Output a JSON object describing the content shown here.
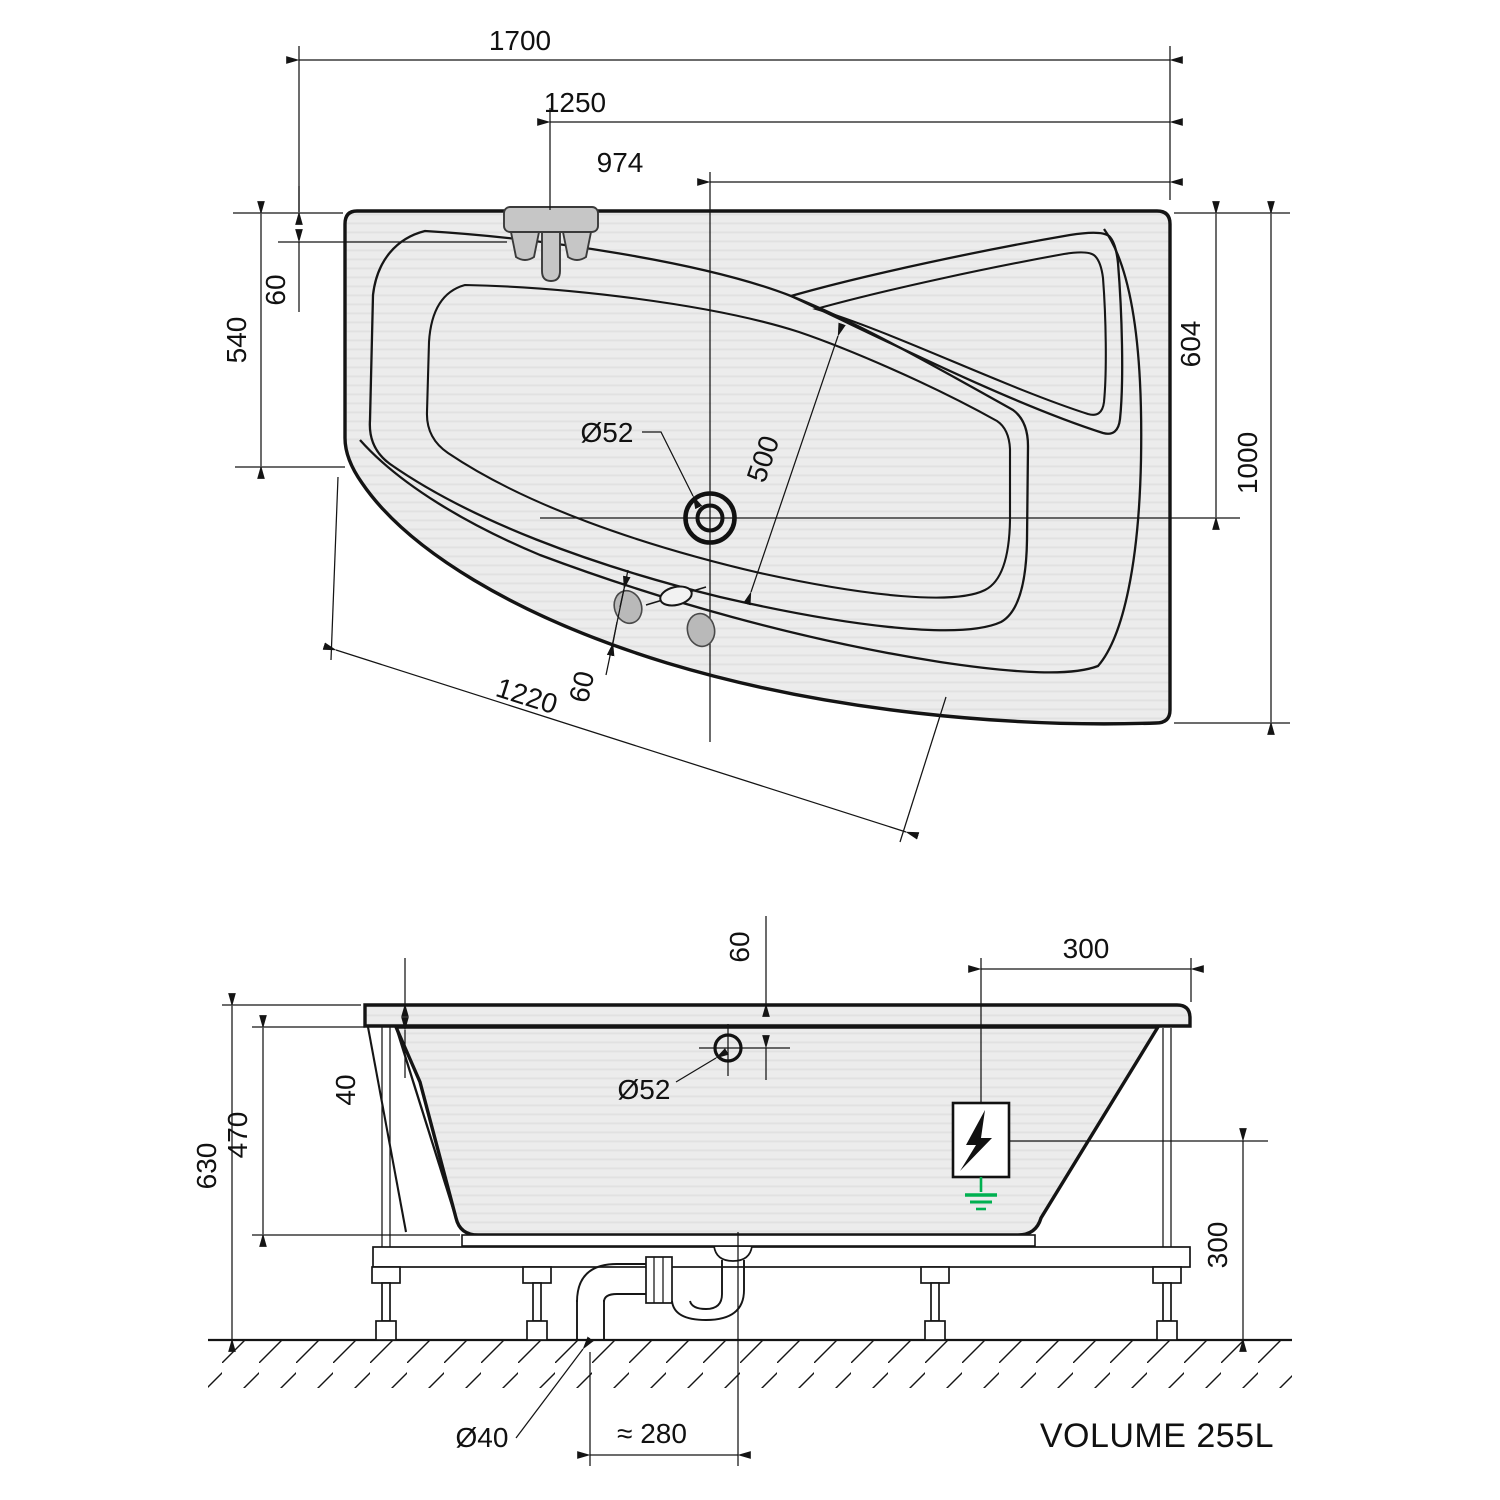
{
  "top_view": {
    "dims": {
      "overall_length": "1700",
      "tap_distance": "1250",
      "drain_offset_x": "974",
      "deck_offset": "60",
      "left_end_width": "540",
      "drain_offset_y": "604",
      "right_end_width": "1000",
      "drain_diameter": "Ø52",
      "basin_width": "500",
      "front_edge_length": "1220",
      "rim_width": "60"
    }
  },
  "side_view": {
    "dims": {
      "overflow_offset": "60",
      "electric_inset": "300",
      "overall_height": "630",
      "shell_depth": "470",
      "rim_height": "40",
      "overflow_diameter": "Ø52",
      "electric_height": "300",
      "waste_pipe_diameter": "Ø40",
      "trap_offset": "≈ 280"
    },
    "volume_label": "VOLUME 255L"
  }
}
